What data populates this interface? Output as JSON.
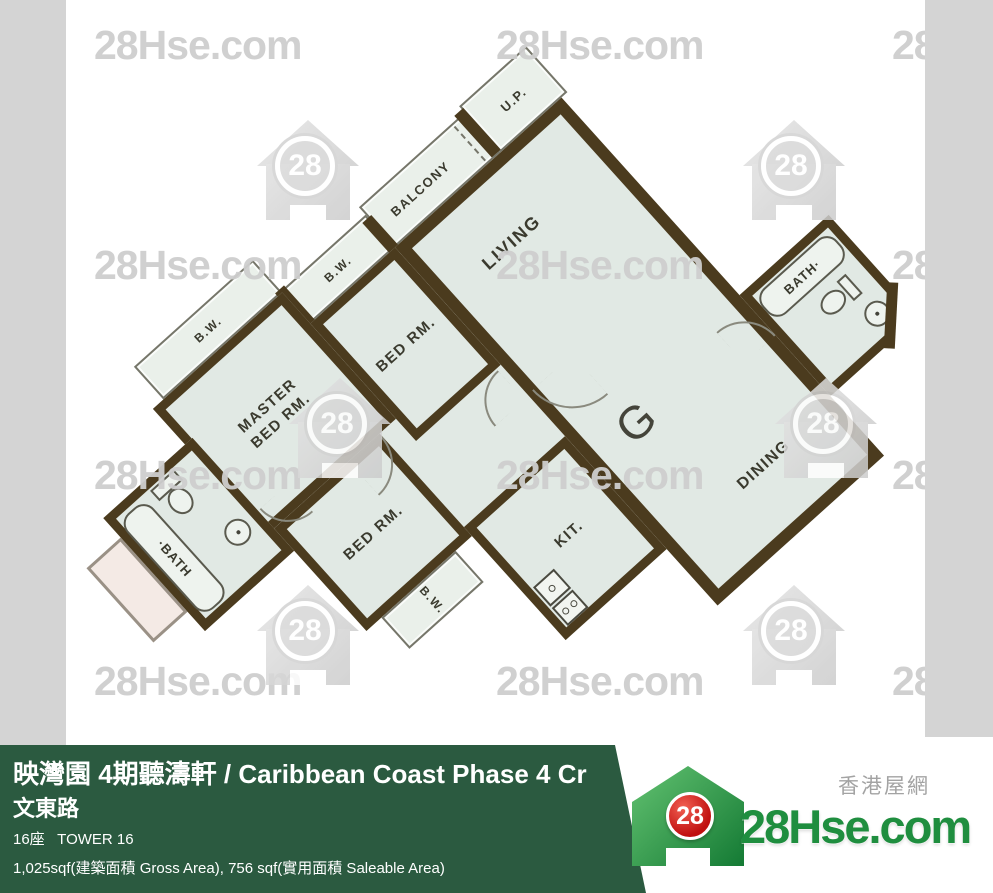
{
  "watermark": {
    "text": "28Hse.com",
    "badge": "28"
  },
  "plan": {
    "unit_label": "G",
    "labels": {
      "living": "LIVING",
      "dining": "DINING",
      "kitchen": "KIT.",
      "balcony": "BALCONY",
      "utility_platform": "U.P.",
      "bay_window": "B.W.",
      "master_bedroom": "MASTER BED RM.",
      "bedroom": "BED RM.",
      "bath_right": "BATH·",
      "bath_left": "·BATH"
    }
  },
  "footer": {
    "title": "映灣園 4期聽濤軒 / Caribbean Coast Phase 4 Cr",
    "street": "文東路",
    "tower": "16座   TOWER 16",
    "area": "1,025sqf(建築面積 Gross Area), 756 sqf(實用面積 Saleable Area)"
  },
  "logo": {
    "badge": "28",
    "name": "28Hse.com",
    "tagline": "香港屋網"
  },
  "colors": {
    "wall": "#4b3b1e",
    "floor": "#e1e9e4",
    "footer_green": "#2b5a40",
    "logo_green": "#1f8e3f",
    "logo_red": "#c01010",
    "watermark_gray": "#d4d4d4"
  }
}
